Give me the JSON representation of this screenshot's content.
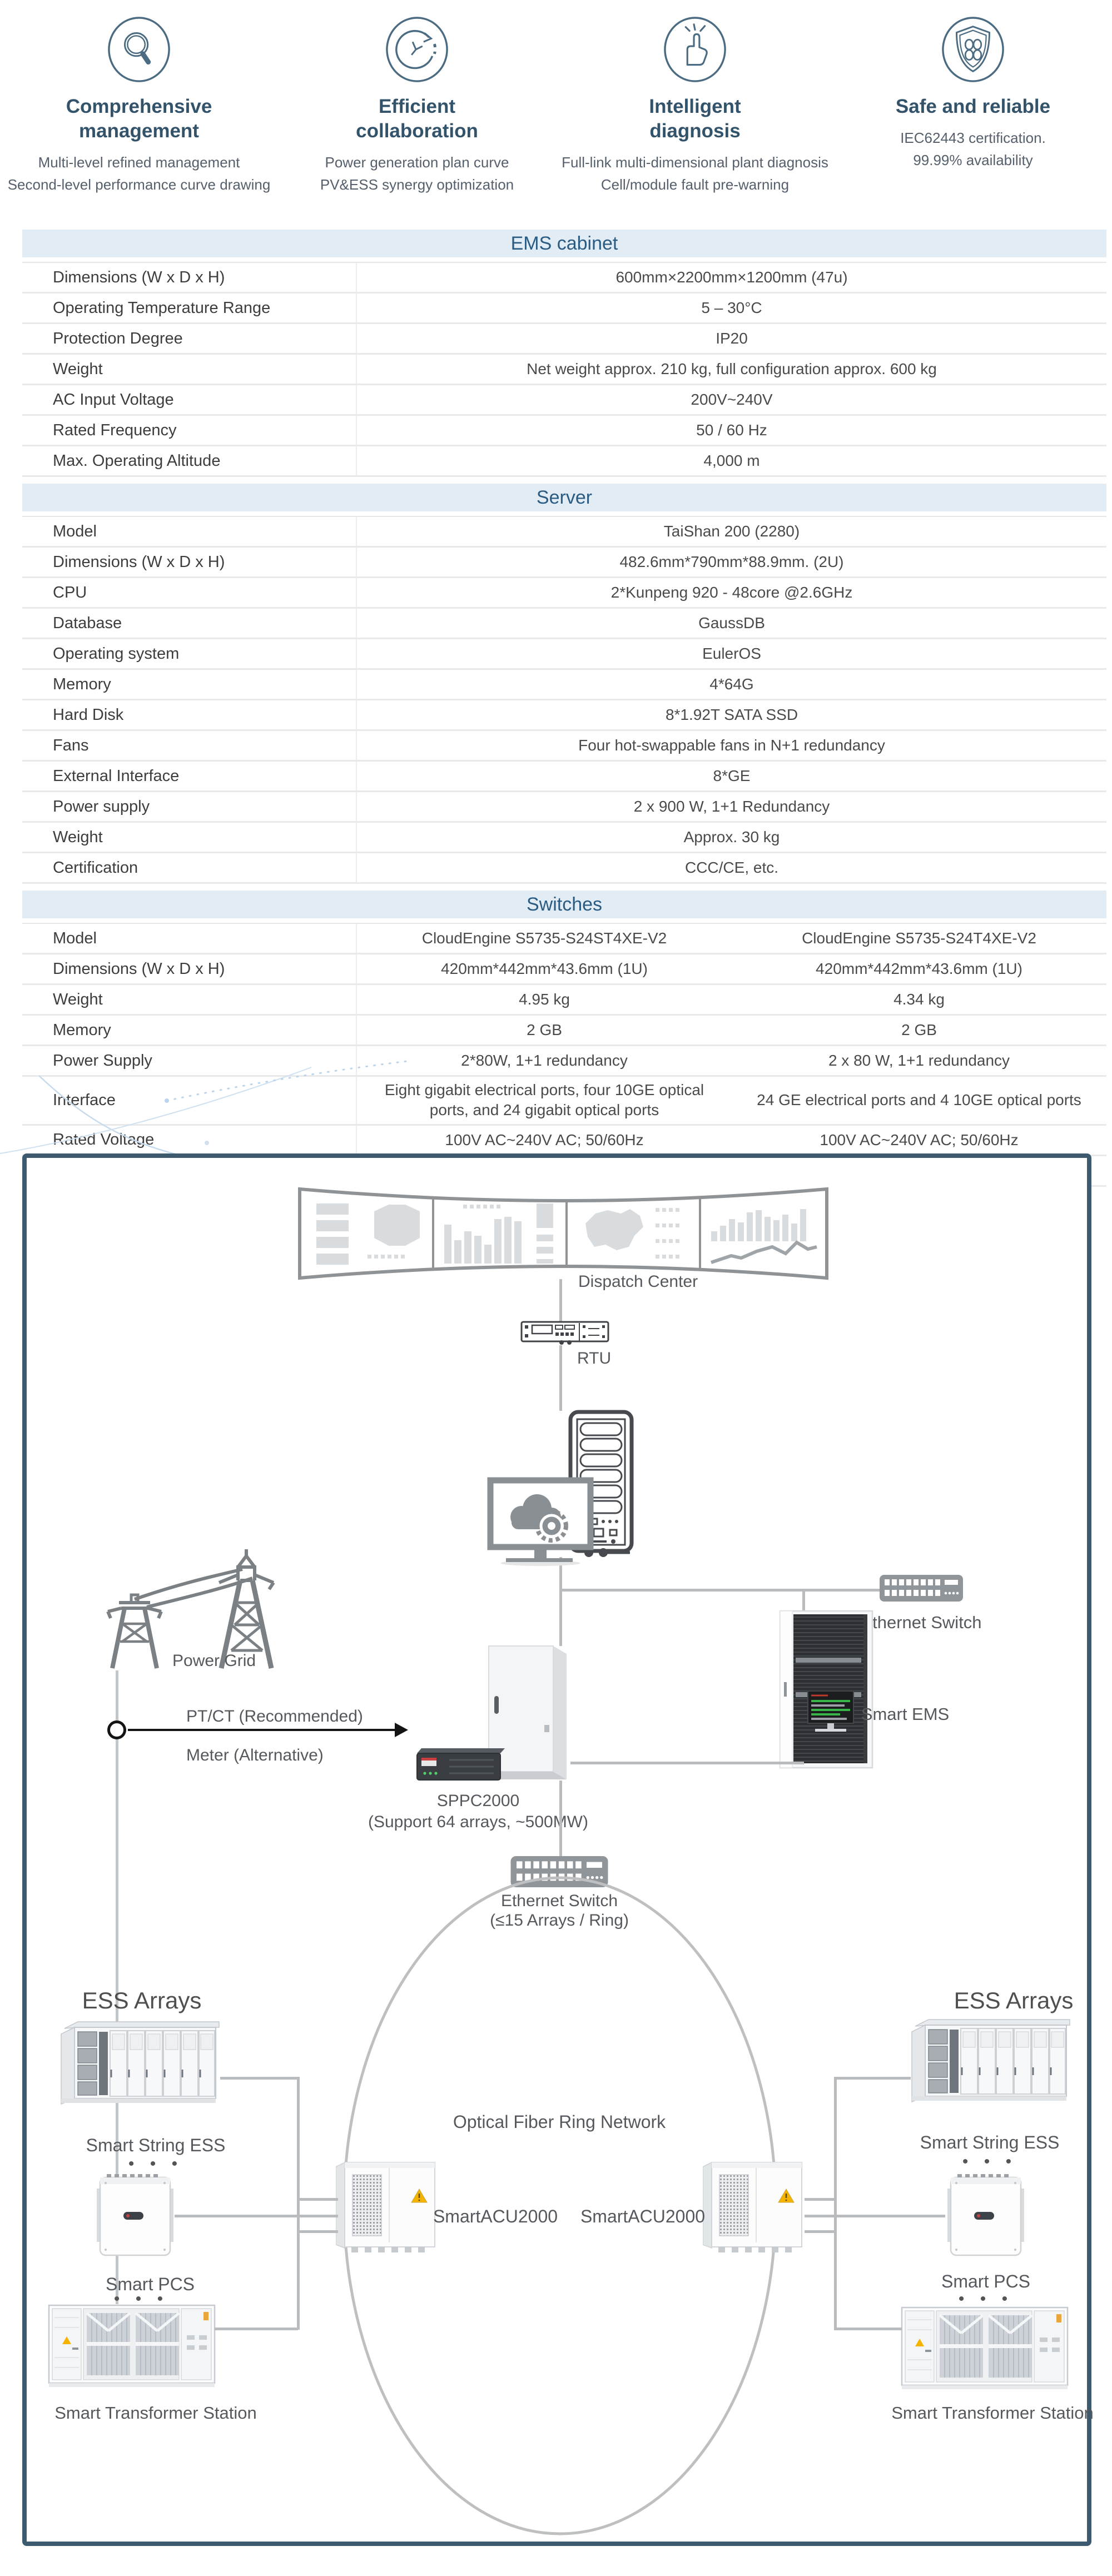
{
  "features": [
    {
      "icon": "magnifier-icon",
      "title": "Comprehensive management",
      "line1": "Multi-level refined management",
      "line2": "Second-level performance curve drawing"
    },
    {
      "icon": "cycle-clock-icon",
      "title": "Efficient collaboration",
      "line1": "Power generation plan curve",
      "line2": "PV&ESS synergy optimization"
    },
    {
      "icon": "snap-fingers-icon",
      "title": "Intelligent diagnosis",
      "line1": "Full-link multi-dimensional plant diagnosis",
      "line2": "Cell/module fault pre-warning"
    },
    {
      "icon": "shield-icon",
      "title": "Safe and reliable",
      "line1": "IEC62443 certification.",
      "line2": "99.99% availability"
    }
  ],
  "tables": {
    "ems": {
      "title": "EMS cabinet",
      "rows": [
        {
          "label": "Dimensions (W x D x H)",
          "value": "600mm×2200mm×1200mm (47u)"
        },
        {
          "label": "Operating Temperature Range",
          "value": "5 – 30°C"
        },
        {
          "label": "Protection Degree",
          "value": "IP20"
        },
        {
          "label": "Weight",
          "value": "Net weight approx. 210 kg, full configuration approx. 600 kg"
        },
        {
          "label": "AC Input Voltage",
          "value": "200V~240V"
        },
        {
          "label": "Rated Frequency",
          "value": "50 / 60 Hz"
        },
        {
          "label": "Max. Operating Altitude",
          "value": "4,000 m"
        }
      ]
    },
    "server": {
      "title": "Server",
      "rows": [
        {
          "label": "Model",
          "value": "TaiShan 200 (2280)"
        },
        {
          "label": "Dimensions (W x D x H)",
          "value": "482.6mm*790mm*88.9mm. (2U)"
        },
        {
          "label": "CPU",
          "value": "2*Kunpeng 920 - 48core @2.6GHz"
        },
        {
          "label": "Database",
          "value": "GaussDB"
        },
        {
          "label": "Operating system",
          "value": "EulerOS"
        },
        {
          "label": "Memory",
          "value": "4*64G"
        },
        {
          "label": "Hard Disk",
          "value": "8*1.92T SATA SSD"
        },
        {
          "label": "Fans",
          "value": "Four hot-swappable fans in N+1 redundancy"
        },
        {
          "label": "External Interface",
          "value": "8*GE"
        },
        {
          "label": "Power supply",
          "value": "2 x 900 W, 1+1 Redundancy"
        },
        {
          "label": "Weight",
          "value": "Approx. 30 kg"
        },
        {
          "label": "Certification",
          "value": "CCC/CE, etc."
        }
      ]
    },
    "switches": {
      "title": "Switches",
      "rows": [
        {
          "label": "Model",
          "value1": "CloudEngine S5735-S24ST4XE-V2",
          "value2": "CloudEngine S5735-S24T4XE-V2"
        },
        {
          "label": "Dimensions (W x D x H)",
          "value1": "420mm*442mm*43.6mm (1U)",
          "value2": "420mm*442mm*43.6mm (1U)"
        },
        {
          "label": "Weight",
          "value1": "4.95 kg",
          "value2": "4.34 kg"
        },
        {
          "label": "Memory",
          "value1": "2 GB",
          "value2": "2 GB"
        },
        {
          "label": "Power Supply",
          "value1": "2*80W, 1+1 redundancy",
          "value2": "2 x 80 W, 1+1 redundancy"
        },
        {
          "label": "Interface",
          "value1": "Eight gigabit electrical ports, four 10GE optical ports, and 24 gigabit optical ports",
          "value2": "24 GE electrical ports and 4 10GE optical ports"
        },
        {
          "label": "Rated Voltage",
          "value1": "100V AC~240V AC; 50/60Hz",
          "value2": "100V AC~240V AC; 50/60Hz"
        },
        {
          "label": "Certification",
          "value1": "CE/VCCI, etc.",
          "value2": "CE/VCCI, etc."
        }
      ]
    }
  },
  "diagram": {
    "dispatch_center": "Dispatch Center",
    "rtu": "RTU",
    "power_grid": "Power Grid",
    "ptct": "PT/CT (Recommended)",
    "meter": "Meter (Alternative)",
    "ethernet_switch": "Ethernet Switch",
    "smart_ems": "Smart EMS",
    "sppc2000": "SPPC2000",
    "sppc2000_sub": "(Support 64 arrays, ~500MW)",
    "ring_switch_line1": "Ethernet Switch",
    "ring_switch_line2": "(≤15 Arrays / Ring)",
    "ring_label": "Optical Fiber Ring Network",
    "smartacu2000": "SmartACU2000",
    "ess_arrays": "ESS Arrays",
    "smart_string_ess": "Smart String ESS",
    "smart_pcs": "Smart PCS",
    "smart_transformer_station": "Smart Transformer Station",
    "dots": "• • •"
  },
  "colors": {
    "accent_blue": "#2a5b82",
    "header_bg": "#e2ecf5",
    "diagram_border": "#3e5a6e",
    "line_gray": "#b9bcbe",
    "warning_yellow": "#f5b301"
  }
}
